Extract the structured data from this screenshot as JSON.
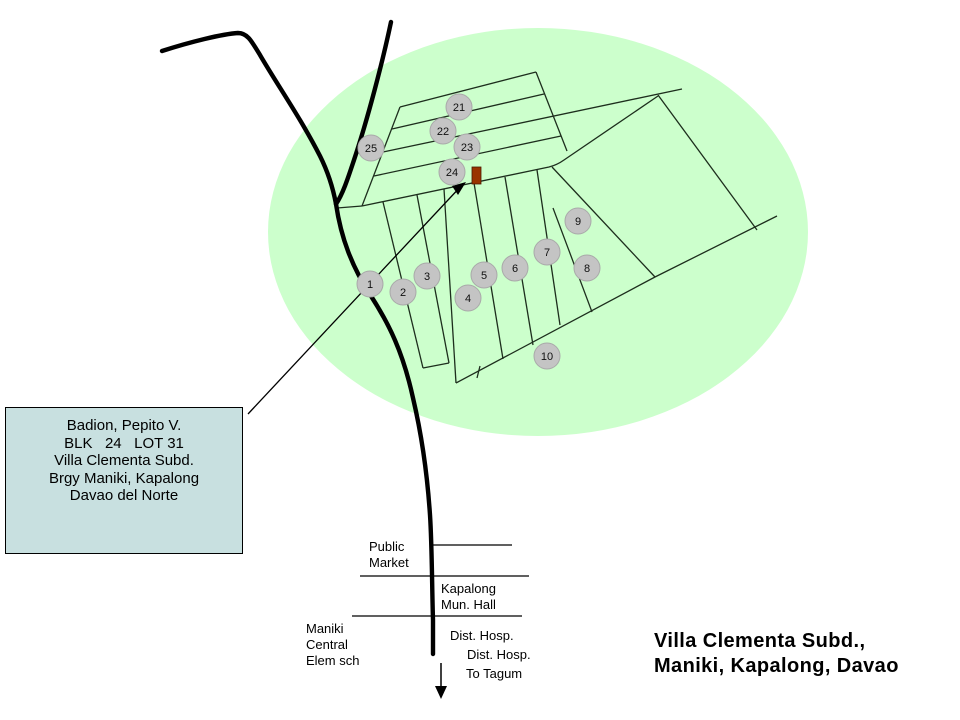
{
  "colors": {
    "subdivision_area_fill": "#ccffcc",
    "block_marker_fill": "#c4c4c4",
    "lot_marker_fill": "#993300",
    "info_box_fill": "#c8e0e0",
    "line_color": "#000000"
  },
  "info_box": {
    "text": "Badion, Pepito V.\nBLK   24   LOT 31\nVilla Clementa Subd.\nBrgy Maniki, Kapalong\nDavao del Norte"
  },
  "landmarks": {
    "public_market": "Public\nMarket",
    "mun_hall": "Kapalong\nMun. Hall",
    "elem_school": "Maniki\nCentral\nElem sch",
    "dist_hosp_upper": "Dist. Hosp.",
    "dist_hosp_lower": "Dist. Hosp.",
    "to_tagum": "To Tagum"
  },
  "title": {
    "text": "Villa Clementa Subd.,\nManiki, Kapalong, Davao"
  },
  "block_markers": [
    {
      "label": "21",
      "x": 459,
      "y": 107
    },
    {
      "label": "22",
      "x": 443,
      "y": 131
    },
    {
      "label": "23",
      "x": 467,
      "y": 147
    },
    {
      "label": "24",
      "x": 452,
      "y": 172
    },
    {
      "label": "25",
      "x": 371,
      "y": 148
    },
    {
      "label": "1",
      "x": 370,
      "y": 284
    },
    {
      "label": "2",
      "x": 403,
      "y": 292
    },
    {
      "label": "3",
      "x": 427,
      "y": 276
    },
    {
      "label": "4",
      "x": 468,
      "y": 298
    },
    {
      "label": "5",
      "x": 484,
      "y": 275
    },
    {
      "label": "6",
      "x": 515,
      "y": 268
    },
    {
      "label": "7",
      "x": 547,
      "y": 252
    },
    {
      "label": "8",
      "x": 587,
      "y": 268
    },
    {
      "label": "9",
      "x": 578,
      "y": 221
    },
    {
      "label": "10",
      "x": 547,
      "y": 356
    }
  ]
}
